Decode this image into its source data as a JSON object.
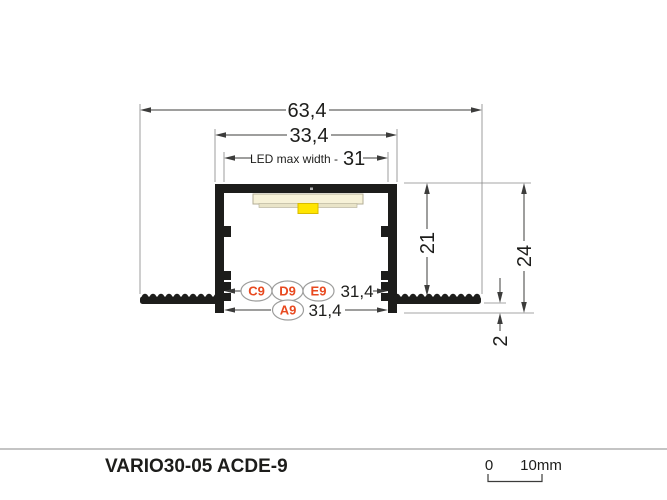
{
  "drawing": {
    "dimensions": {
      "total_width": "63,4",
      "outer_width": "33,4",
      "led_max_width_label": "LED max width -",
      "led_max_width_value": "31",
      "inner_depth": "21",
      "total_height": "24",
      "flange_thickness": "2",
      "top_spacing": "31,4",
      "bottom_spacing": "31,4"
    },
    "markers": {
      "c9": "C9",
      "d9": "D9",
      "e9": "E9",
      "a9": "A9"
    },
    "colors": {
      "profile": "#1d1d1b",
      "accent": "#e8491f",
      "badge_border": "#9d9d9c",
      "led_strip": "#f7f2d8",
      "led_strip_shadow": "#e9e4c8",
      "led_strip_border": "#b3ae96",
      "led": "#ffe500",
      "led_border": "#d8bb00",
      "dim_line": "#3c3c3b",
      "ext_line": "#868686",
      "divider": "#c4c4c4"
    }
  },
  "footer": {
    "title": "VARIO30-05 ACDE-9",
    "scale_zero": "0",
    "scale_end": "10mm"
  }
}
